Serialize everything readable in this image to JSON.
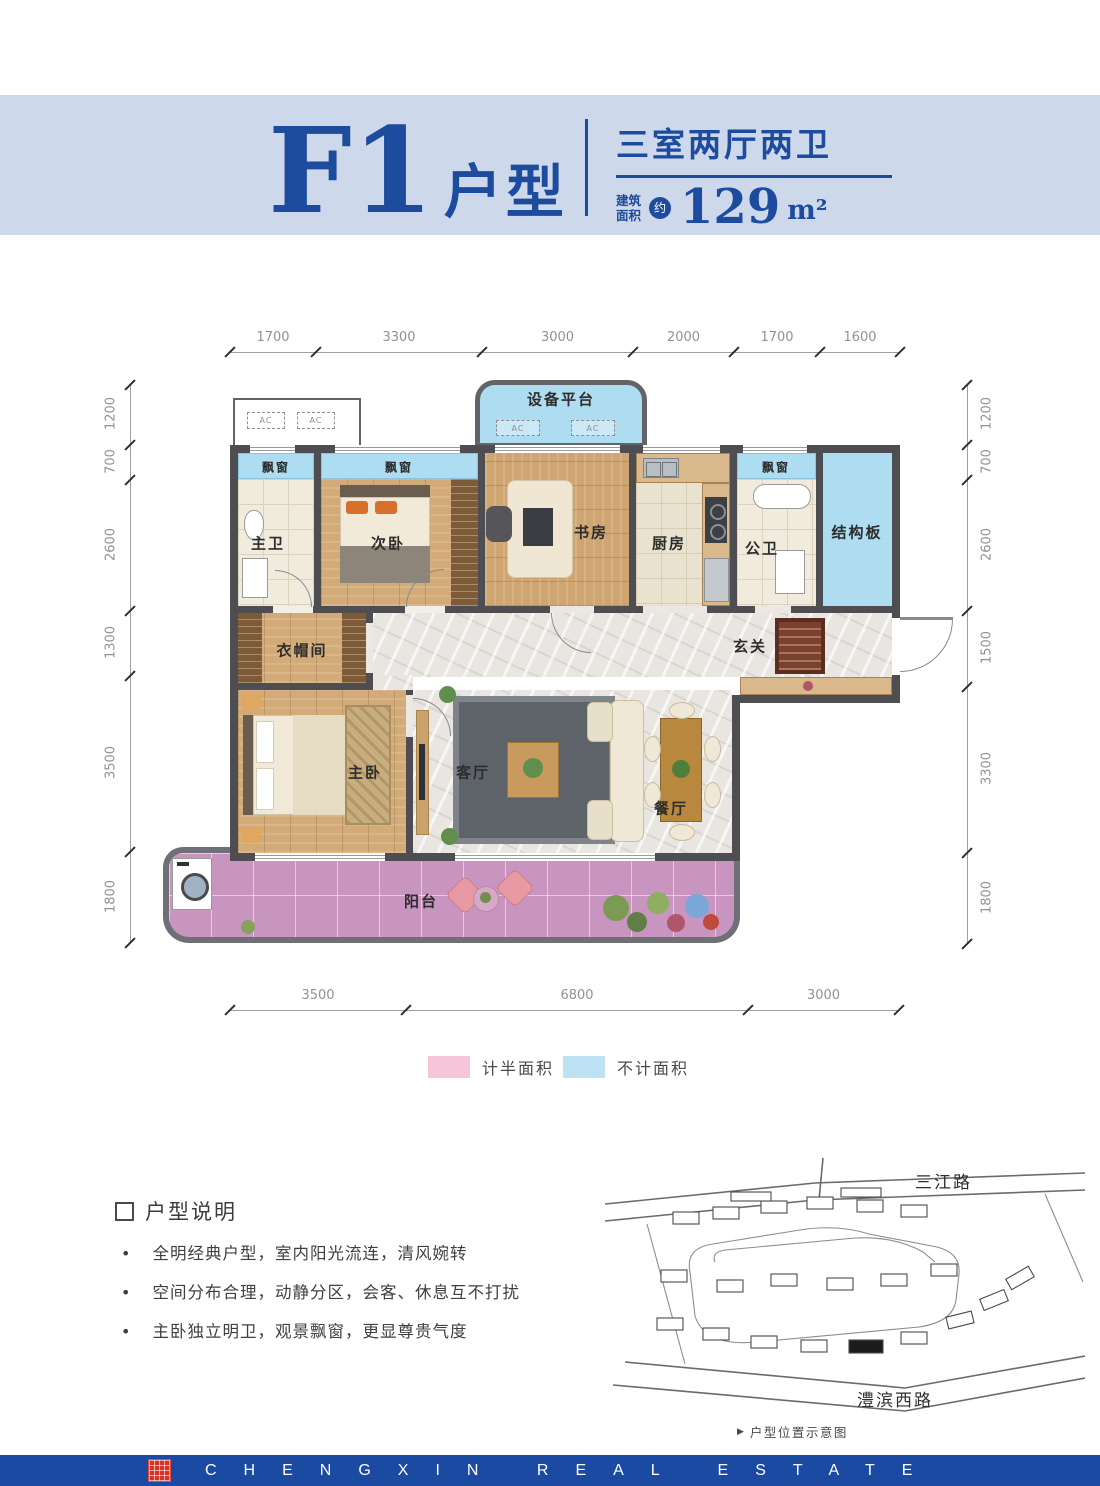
{
  "header": {
    "unit_name": "F1",
    "unit_type_suffix": "户型",
    "layout_summary": "三室两厅两卫",
    "area_prefix_line1": "建筑",
    "area_prefix_line2": "面积",
    "area_approx_badge": "约",
    "area_value": "129",
    "area_unit": "m²"
  },
  "floor_plan": {
    "dimensions": {
      "top": [
        "1700",
        "3300",
        "3000",
        "2000",
        "1700",
        "1600"
      ],
      "bottom": [
        "3500",
        "6800",
        "3000"
      ],
      "left": [
        "1200",
        "700",
        "2600",
        "1300",
        "3500",
        "1800"
      ],
      "right": [
        "1200",
        "700",
        "2600",
        "1500",
        "3300",
        "1800"
      ]
    },
    "rooms": {
      "equipment_platform": "设备平台",
      "ac_unit": "AC",
      "bay_window": "飘窗",
      "master_bathroom": "主卫",
      "second_bedroom": "次卧",
      "study": "书房",
      "kitchen": "厨房",
      "public_bathroom": "公卫",
      "structural_slab": "结构板",
      "cloakroom": "衣帽间",
      "foyer": "玄关",
      "master_bedroom": "主卧",
      "living_room": "客厅",
      "dining_room": "餐厅",
      "balcony": "阳台"
    }
  },
  "legend": {
    "half_area": {
      "label": "计半面积",
      "color": "#f6c5d9"
    },
    "excluded_area": {
      "label": "不计面积",
      "color": "#bde2f4"
    }
  },
  "notes": {
    "title": "户型说明",
    "items": [
      "全明经典户型，室内阳光流连，清风婉转",
      "空间分布合理，动静分区，会客、休息互不打扰",
      "主卧独立明卫，观景飘窗，更显尊贵气度"
    ]
  },
  "site_map": {
    "top_road": "三江路",
    "bottom_road": "澧滨西路",
    "caption": "户型位置示意图"
  },
  "footer": {
    "brand_text": "CHENGXIN REAL ESTATE"
  },
  "colors": {
    "accent_blue": "#1d4b9e",
    "header_band": "#cdd9eb",
    "wall": "#4e4e52",
    "excluded_blue": "#aedcf0",
    "balcony_pink": "#c795bf",
    "footer_blue": "#1b4aa2",
    "seal_red": "#d23527"
  }
}
